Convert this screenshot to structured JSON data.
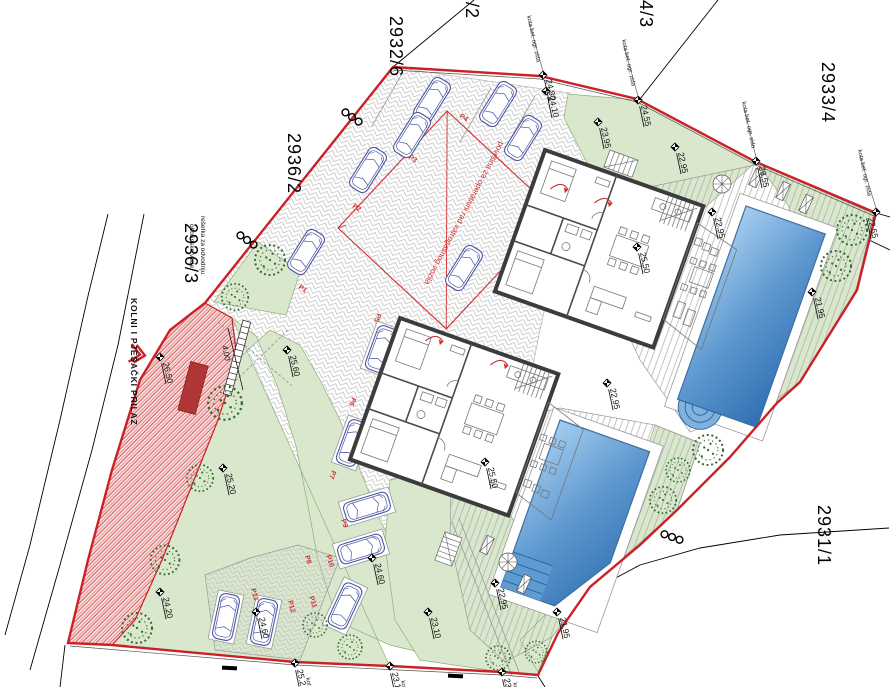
{
  "drawing": {
    "type": "architectural site plan"
  },
  "parcels": {
    "top_partial": "/2",
    "n1": "2932/6",
    "n2": "2936/2",
    "n3": "2936/3",
    "n4": "4/3",
    "n5": "2933/4",
    "n6": "2931/1"
  },
  "labels": {
    "access_road": "KOLNI I PJEŠAČKI PRILAZ",
    "drain1": "rešetka za odvodnju",
    "drain2": "oborinske vode",
    "fire_area": "površina za operativni rad vatrogasnog vozila",
    "wall_note": "kota bet. ogr. zida",
    "wall_note_frag": "kot",
    "gate_width": "4.00"
  },
  "elevations": {
    "e1": "24.80",
    "e2": "24.10",
    "e3": "24.55",
    "e4": "23.95",
    "e5": "22.95",
    "e6": "23.55",
    "e7": "22.55",
    "e8": "22.95",
    "e9": "25.50",
    "e10": "21.95",
    "e11": "25.60",
    "e12": "26.50",
    "e13": "25.50",
    "e14": "25.20",
    "e15": "22.95",
    "e16": "21.95",
    "e17": "24.20",
    "e18": "24.60",
    "e19": "24.60",
    "e20": "23.10",
    "e21": "25.2",
    "e22": "23.1",
    "e23": "23.",
    "e24": "22.95"
  },
  "parking": {
    "p1": "P1",
    "p2": "P2",
    "p3": "P3",
    "p4": "P4",
    "p5": "P5",
    "p6": "P6",
    "p7": "P7",
    "p8": "P8",
    "p9": "P9",
    "p10": "P10",
    "p11": "P11",
    "p12": "P12",
    "p13": "P13"
  },
  "colors": {
    "boundary_red": "#cc2027",
    "pool_blue": "#3f86c9",
    "landscape_green": "#d9e8cc",
    "car_blue": "#4a55a2",
    "access_hatch_red": "#d04040",
    "fire_area_red": "#d03030"
  }
}
